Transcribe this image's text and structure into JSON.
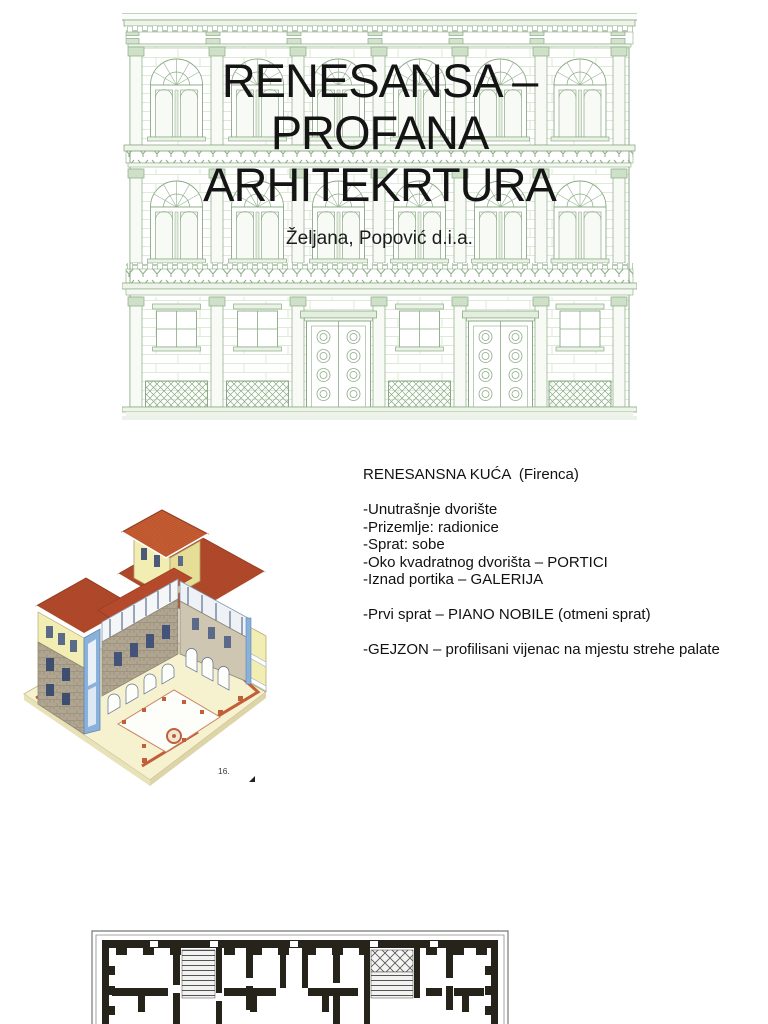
{
  "slide1": {
    "title": "RENESANSA – PROFANA ARHITEKRTURA",
    "subtitle": "Željana, Popović d.i.a.",
    "background_image": "renaissance-palace-facade-line-drawing"
  },
  "slide2": {
    "image": "renaissance-house-isometric-cutaway",
    "image_caption": "16.",
    "text_lines": [
      "RENESANSNA KUĆA  (Firenca)",
      "",
      "-Unutrašnje dvorište",
      "-Prizemlje: radionice",
      "-Sprat: sobe",
      "-Oko kvadratnog dvorišta – PORTICI",
      "-Iznad portika – GALERIJA",
      "",
      "-Prvi sprat – PIANO NOBILE (otmeni sprat)",
      "",
      "-GEJZON – profilisani vijenac na mjestu strehe palate"
    ]
  },
  "slide3": {
    "image": "palace-ground-floor-plan-black-and-white"
  },
  "colors": {
    "facade_line_green": "#8aaa84",
    "title_text": "#141414",
    "body_text": "#111111",
    "roof_red": "#b44a2b",
    "wall_yellow": "#f2edb2",
    "stone_gray": "#b0a590",
    "section_cut_blue": "#8ab1d9",
    "plan_terracotta": "#c05f3a",
    "floorplan_wall": "#26231a"
  }
}
